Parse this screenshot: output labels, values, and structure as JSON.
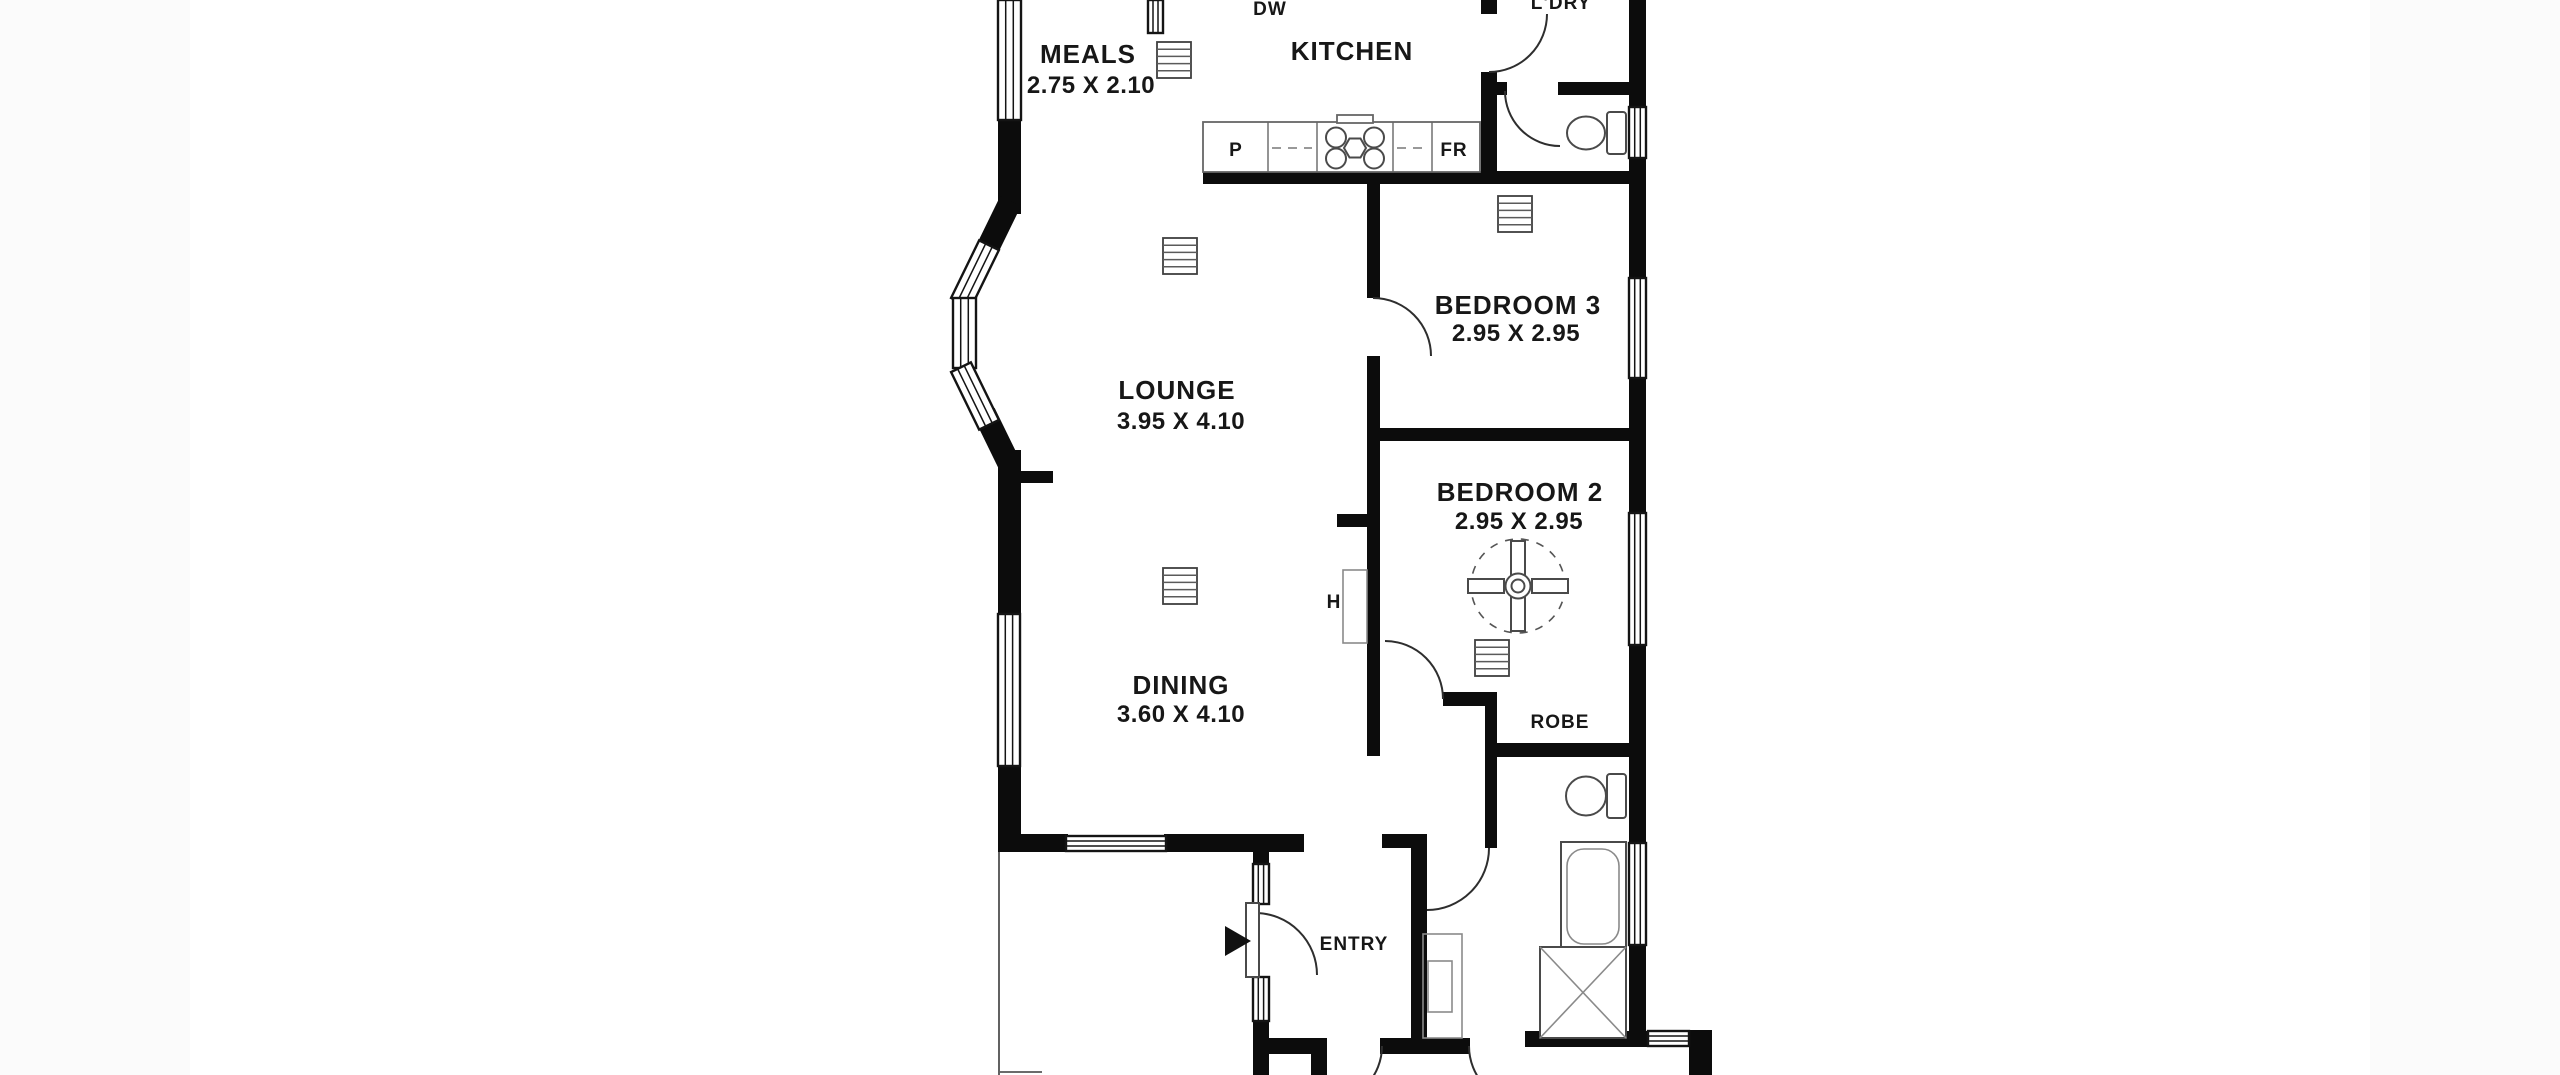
{
  "labels": {
    "meals": {
      "name": "MEALS",
      "dims": "2.75 X 2.10"
    },
    "kitchen": {
      "name": "KITCHEN"
    },
    "laundry": {
      "name": "L'DRY"
    },
    "bedroom3": {
      "name": "BEDROOM 3",
      "dims": "2.95 X 2.95"
    },
    "lounge": {
      "name": "LOUNGE",
      "dims": "3.95 X 4.10"
    },
    "bedroom2": {
      "name": "BEDROOM 2",
      "dims": "2.95 X 2.95"
    },
    "dining": {
      "name": "DINING",
      "dims": "3.60 X 4.10"
    },
    "robe": {
      "name": "ROBE"
    },
    "entry": {
      "name": "ENTRY"
    }
  },
  "appliances": {
    "dishwasher": "DW",
    "pantry": "P",
    "fridge": "FR",
    "hot_water": "H"
  },
  "icons": [
    "heater-vent-icon",
    "ceiling-fan-icon",
    "cooktop-icon",
    "toilet-icon",
    "bathtub-icon",
    "shower-icon",
    "entry-arrow-icon",
    "window-symbol",
    "door-swing-symbol"
  ],
  "colors": {
    "wall": "#0c0c0c",
    "background_panel": "#ffffff",
    "background_margin": "#fbfbfb",
    "fixture_outline": "#4a4a4a",
    "text": "#171717"
  }
}
